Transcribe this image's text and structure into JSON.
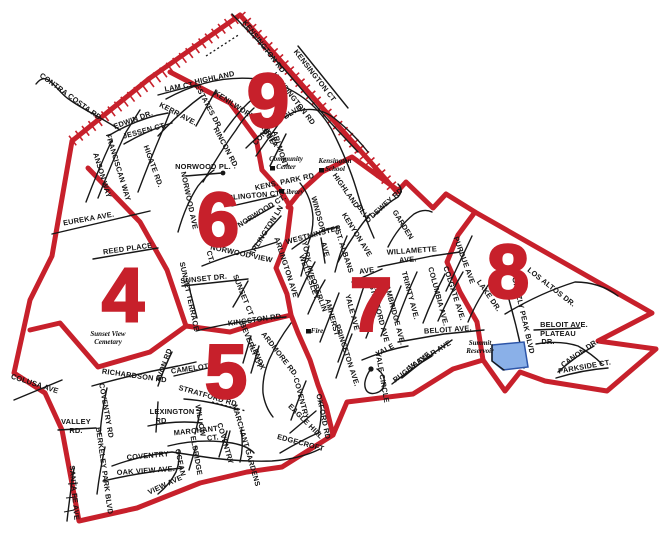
{
  "map": {
    "colors": {
      "boundary_red": "#c7202b",
      "road_black": "#171717",
      "reservoir_fill": "#8ab0e8",
      "reservoir_stroke": "#2d55a8"
    },
    "districts": [
      {
        "n": "9",
        "x": 268,
        "y": 127,
        "s": 88
      },
      {
        "n": "6",
        "x": 218,
        "y": 246
      },
      {
        "n": "4",
        "x": 123,
        "y": 321
      },
      {
        "n": "5",
        "x": 226,
        "y": 398
      },
      {
        "n": "7",
        "x": 371,
        "y": 331
      },
      {
        "n": "8",
        "x": 508,
        "y": 298
      }
    ],
    "street_labels": [
      {
        "t": "KENSINGTON RD",
        "x": 262,
        "y": 48,
        "r": 52
      },
      {
        "t": "KENSINGTON RD",
        "x": 292,
        "y": 100,
        "r": 52,
        "s": 7
      },
      {
        "t": "KENSINGTON CT",
        "x": 313,
        "y": 77,
        "r": 52
      },
      {
        "t": "HIGHLAND",
        "x": 215,
        "y": 80,
        "r": -12
      },
      {
        "t": "LAM CT.",
        "x": 180,
        "y": 89,
        "r": -10,
        "s": 7
      },
      {
        "t": "KERR AVE.",
        "x": 177,
        "y": 116,
        "r": 28
      },
      {
        "t": "ESTATES DR",
        "x": 206,
        "y": 107,
        "r": 62,
        "s": 6.6
      },
      {
        "t": "KENILWORTH DR",
        "x": 241,
        "y": 112,
        "r": 33,
        "s": 6.6
      },
      {
        "t": "EDWIN DR.",
        "x": 134,
        "y": 122,
        "r": -20
      },
      {
        "t": "JESSEN CT.",
        "x": 145,
        "y": 133,
        "r": -15
      },
      {
        "t": "HIGATE RD.",
        "x": 151,
        "y": 167,
        "r": 70
      },
      {
        "t": "FRANCISCAN WAY",
        "x": 116,
        "y": 168,
        "r": 73
      },
      {
        "t": "ANSON WAY",
        "x": 100,
        "y": 176,
        "r": 73
      },
      {
        "t": "CONTRA COSTA RD.",
        "x": 70,
        "y": 99,
        "r": 36,
        "s": 6.6
      },
      {
        "t": "EUREKA AVE.",
        "x": 89,
        "y": 221,
        "r": -10
      },
      {
        "t": "RINCON RD.",
        "x": 224,
        "y": 149,
        "r": 62
      },
      {
        "t": "CONCORD",
        "x": 269,
        "y": 131,
        "r": -48,
        "s": 6.8
      },
      {
        "t": "BLVD",
        "x": 294,
        "y": 114,
        "r": -32,
        "s": 6.8
      },
      {
        "t": "MARGUE-",
        "x": 263,
        "y": 131,
        "r": 58,
        "s": 6.6
      },
      {
        "t": "RITA",
        "x": 270,
        "y": 140,
        "r": 58,
        "s": 6.6
      },
      {
        "t": "ARLMONT",
        "x": 278,
        "y": 150,
        "r": 72,
        "s": 6.8
      },
      {
        "t": "NORWOOD PL.",
        "x": 203,
        "y": 169,
        "r": 0
      },
      {
        "t": "NORWOOD AVE",
        "x": 187,
        "y": 201,
        "r": 78
      },
      {
        "t": "ARLINGTON CT.",
        "x": 252,
        "y": 198,
        "r": -5
      },
      {
        "t": "NORWOOD CT.",
        "x": 263,
        "y": 213,
        "r": -32,
        "s": 6.8
      },
      {
        "t": "ARLINGTON LN",
        "x": 268,
        "y": 232,
        "r": -58,
        "s": 6.8
      },
      {
        "t": "NORWOOD VIEW",
        "x": 241,
        "y": 256,
        "r": 12,
        "s": 6.8
      },
      {
        "t": "CT.",
        "x": 208,
        "y": 257,
        "r": 75,
        "s": 6.4
      },
      {
        "t": "ARLINGTON AVE",
        "x": 284,
        "y": 268,
        "r": 72
      },
      {
        "t": "SUNSET DR.",
        "x": 204,
        "y": 281,
        "r": -6
      },
      {
        "t": "SUNSET TERRACE",
        "x": 187,
        "y": 297,
        "r": 78,
        "s": 6.4
      },
      {
        "t": "SUNSET CT",
        "x": 241,
        "y": 296,
        "r": 68,
        "s": 6.6
      },
      {
        "t": "REED PLACE",
        "x": 128,
        "y": 251,
        "r": -8
      },
      {
        "t": "KINGSTON RD.",
        "x": 256,
        "y": 322,
        "r": -8
      },
      {
        "t": "KENS. PARK RD",
        "x": 285,
        "y": 184,
        "r": -12,
        "s": 6.6
      },
      {
        "t": "WINDSOR",
        "x": 316,
        "y": 215,
        "r": 75
      },
      {
        "t": "WESTMINSTER",
        "x": 314,
        "y": 237,
        "r": -15
      },
      {
        "t": "AVE",
        "x": 323,
        "y": 250,
        "r": 75,
        "s": 7
      },
      {
        "t": "YORK AVE",
        "x": 306,
        "y": 261,
        "r": 78
      },
      {
        "t": "ST. ALBANS",
        "x": 342,
        "y": 252,
        "r": 72
      },
      {
        "t": "HIGHLAND",
        "x": 344,
        "y": 192,
        "r": 55
      },
      {
        "t": "BLVD",
        "x": 362,
        "y": 215,
        "r": 58
      },
      {
        "t": "KENYON AVE",
        "x": 355,
        "y": 236,
        "r": 58
      },
      {
        "t": "DEWEY RD",
        "x": 388,
        "y": 205,
        "r": -42,
        "s": 6.6
      },
      {
        "t": "GARDEN",
        "x": 401,
        "y": 226,
        "r": 58
      },
      {
        "t": "WILLAMETTE",
        "x": 412,
        "y": 253,
        "r": -4
      },
      {
        "t": "AVE.",
        "x": 408,
        "y": 262,
        "r": -4
      },
      {
        "t": "AVE",
        "x": 367,
        "y": 273,
        "r": -8,
        "s": 7
      },
      {
        "t": "PURDUE AVE",
        "x": 462,
        "y": 261,
        "r": 70
      },
      {
        "t": "COLGATE AVE.",
        "x": 452,
        "y": 294,
        "r": 72
      },
      {
        "t": "COLUMBIA AVE.",
        "x": 436,
        "y": 297,
        "r": 75
      },
      {
        "t": "TRINITY AVE.",
        "x": 408,
        "y": 296,
        "r": 75
      },
      {
        "t": "CAMBRIDGE AVE.",
        "x": 392,
        "y": 313,
        "r": 75
      },
      {
        "t": "STANFORD AVE",
        "x": 377,
        "y": 314,
        "r": 75
      },
      {
        "t": "YALE AVE",
        "x": 350,
        "y": 313,
        "r": 75
      },
      {
        "t": "AMHERST",
        "x": 330,
        "y": 318,
        "r": 75
      },
      {
        "t": "OBERLIN",
        "x": 317,
        "y": 296,
        "r": 70
      },
      {
        "t": "WELLESLEY",
        "x": 307,
        "y": 278,
        "r": 70
      },
      {
        "t": "PRINCETON AVE.",
        "x": 345,
        "y": 356,
        "r": 72
      },
      {
        "t": "YALE",
        "x": 386,
        "y": 352,
        "r": -28
      },
      {
        "t": "YALE CIRCLE",
        "x": 380,
        "y": 378,
        "r": 80,
        "s": 6.6
      },
      {
        "t": "VASSAR AVE",
        "x": 431,
        "y": 357,
        "r": -32
      },
      {
        "t": "RUGBY AVE",
        "x": 413,
        "y": 369,
        "r": -38
      },
      {
        "t": "BELOIT AVE.",
        "x": 448,
        "y": 332,
        "r": -4
      },
      {
        "t": "LAKE DR.",
        "x": 487,
        "y": 297,
        "r": 55
      },
      {
        "t": "LOS ALTOS DR.",
        "x": 550,
        "y": 289,
        "r": 38
      },
      {
        "t": "GRIZZLY PEAK BLVD",
        "x": 521,
        "y": 316,
        "r": 77,
        "s": 6.6
      },
      {
        "t": "BELOIT AVE.",
        "x": 564,
        "y": 327,
        "r": 0,
        "s": 7
      },
      {
        "t": "PLATEAU",
        "x": 558,
        "y": 336,
        "r": 0,
        "s": 7
      },
      {
        "t": "DR.",
        "x": 548,
        "y": 344,
        "r": 0,
        "s": 7
      },
      {
        "t": "CANON DR.",
        "x": 581,
        "y": 355,
        "r": -35
      },
      {
        "t": "PARKSIDE CT.",
        "x": 585,
        "y": 369,
        "r": -10
      },
      {
        "t": "RICHARDSON RD",
        "x": 134,
        "y": 378,
        "r": 8
      },
      {
        "t": "AVON RD",
        "x": 166,
        "y": 366,
        "r": -70
      },
      {
        "t": "CAMELOT",
        "x": 190,
        "y": 371,
        "r": -8
      },
      {
        "t": "BEVERLY CT",
        "x": 249,
        "y": 346,
        "r": 68,
        "s": 6.6
      },
      {
        "t": "LENOX",
        "x": 256,
        "y": 358,
        "r": 68,
        "s": 6.6
      },
      {
        "t": "STRATFORD RD",
        "x": 207,
        "y": 398,
        "r": 16
      },
      {
        "t": "LEXINGTON",
        "x": 172,
        "y": 414,
        "r": 0
      },
      {
        "t": "RD",
        "x": 161,
        "y": 423,
        "r": 0
      },
      {
        "t": "COVENTRY RD",
        "x": 104,
        "y": 411,
        "r": 80,
        "s": 6.8
      },
      {
        "t": "VALLEY",
        "x": 76,
        "y": 424,
        "r": 0
      },
      {
        "t": "RD.",
        "x": 76,
        "y": 433,
        "r": 0
      },
      {
        "t": "WILLOW",
        "x": 198,
        "y": 421,
        "r": 80,
        "s": 6.4
      },
      {
        "t": "MARCHANT",
        "x": 196,
        "y": 433,
        "r": -6
      },
      {
        "t": "CT.",
        "x": 213,
        "y": 440,
        "r": -6,
        "s": 6.6
      },
      {
        "t": "COVENTRY",
        "x": 223,
        "y": 444,
        "r": 74,
        "s": 6.4
      },
      {
        "t": "MARCHANT GARDENS",
        "x": 244,
        "y": 446,
        "r": 74,
        "s": 6.2
      },
      {
        "t": "ELDRIDGE",
        "x": 194,
        "y": 456,
        "r": 80,
        "s": 6.6
      },
      {
        "t": "COVENTRY",
        "x": 148,
        "y": 458,
        "r": -5
      },
      {
        "t": "BERKELEY PARK BLVD",
        "x": 102,
        "y": 471,
        "r": 82,
        "s": 6.2
      },
      {
        "t": "OAK VIEW AVE.",
        "x": 146,
        "y": 473,
        "r": -4
      },
      {
        "t": "SANTA FE AVE",
        "x": 72,
        "y": 493,
        "r": 85,
        "s": 6.8
      },
      {
        "t": "OCEAN",
        "x": 178,
        "y": 463,
        "r": 78,
        "s": 6.4
      },
      {
        "t": "VIEW AVE",
        "x": 166,
        "y": 487,
        "r": -25,
        "s": 6.6
      },
      {
        "t": "ARDMORE RD.",
        "x": 278,
        "y": 356,
        "r": 52
      },
      {
        "t": "COVENTRY",
        "x": 299,
        "y": 399,
        "r": 75,
        "s": 6.8
      },
      {
        "t": "EAGLE HILL",
        "x": 304,
        "y": 423,
        "r": 45,
        "s": 6.6
      },
      {
        "t": "EDGECROFT",
        "x": 300,
        "y": 445,
        "r": 15,
        "s": 6.8
      },
      {
        "t": "OXFORD RD",
        "x": 321,
        "y": 417,
        "r": 78,
        "s": 6.4
      },
      {
        "t": "COLUSA AVE",
        "x": 34,
        "y": 386,
        "r": 18
      }
    ],
    "landmarks": [
      {
        "lines": [
          "Community",
          "Center"
        ],
        "x": 286,
        "y": 161,
        "marker": {
          "x": 270,
          "y": 166
        }
      },
      {
        "lines": [
          "Kensington",
          "School"
        ],
        "x": 335,
        "y": 163,
        "marker": {
          "x": 319,
          "y": 168
        }
      },
      {
        "lines": [
          "Library"
        ],
        "x": 293,
        "y": 194,
        "marker": {
          "x": 279,
          "y": 189
        }
      },
      {
        "lines": [
          "Fire"
        ],
        "x": 317,
        "y": 333,
        "marker": {
          "x": 306,
          "y": 329
        }
      },
      {
        "lines": [
          "Sunset View",
          "Cemetary"
        ],
        "x": 108,
        "y": 336
      },
      {
        "lines": [
          "Summit",
          "Reservoir"
        ],
        "x": 480,
        "y": 345
      }
    ]
  }
}
